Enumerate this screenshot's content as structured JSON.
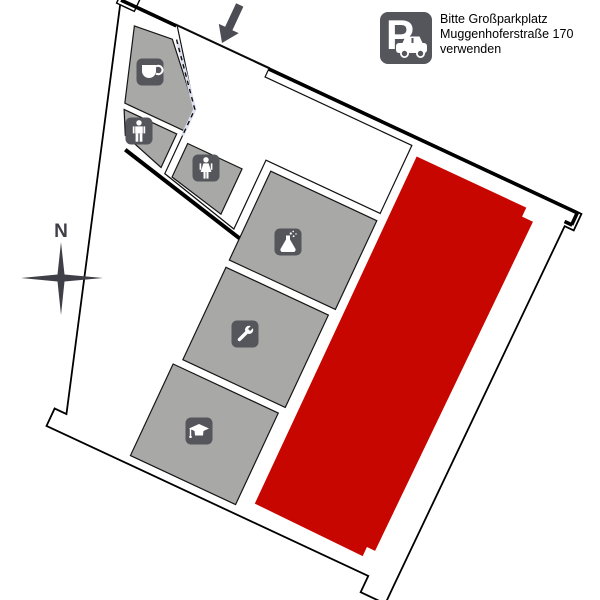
{
  "title": "building-floor-plan",
  "compass": {
    "label": "N"
  },
  "parking_note": {
    "icon": "parking-sign-icon",
    "sign_letter": "P",
    "lines": [
      "Bitte Großparkplatz",
      "Muggenhoferstraße 170",
      "verwenden"
    ]
  },
  "rooms": [
    {
      "id": "cafe",
      "icon": "coffee-cup-icon"
    },
    {
      "id": "wc-men",
      "icon": "man-icon"
    },
    {
      "id": "wc-women",
      "icon": "woman-icon"
    },
    {
      "id": "laboratory",
      "icon": "flask-icon"
    },
    {
      "id": "workshop",
      "icon": "wrench-icon"
    },
    {
      "id": "lecture",
      "icon": "graduation-cap-icon"
    }
  ],
  "highlighted_area": {
    "id": "main-hall-highlight"
  },
  "colors": {
    "background": "#ffffff",
    "wall": "#000000",
    "room_fill": "#a8a8a6",
    "corridor_fill": "#dde0f0",
    "highlight_fill": "#c80600",
    "icon_bg": "#55555c",
    "icon_glyph": "#ffffff",
    "arrow": "#4c4c54",
    "compass": "#3f3f47"
  }
}
